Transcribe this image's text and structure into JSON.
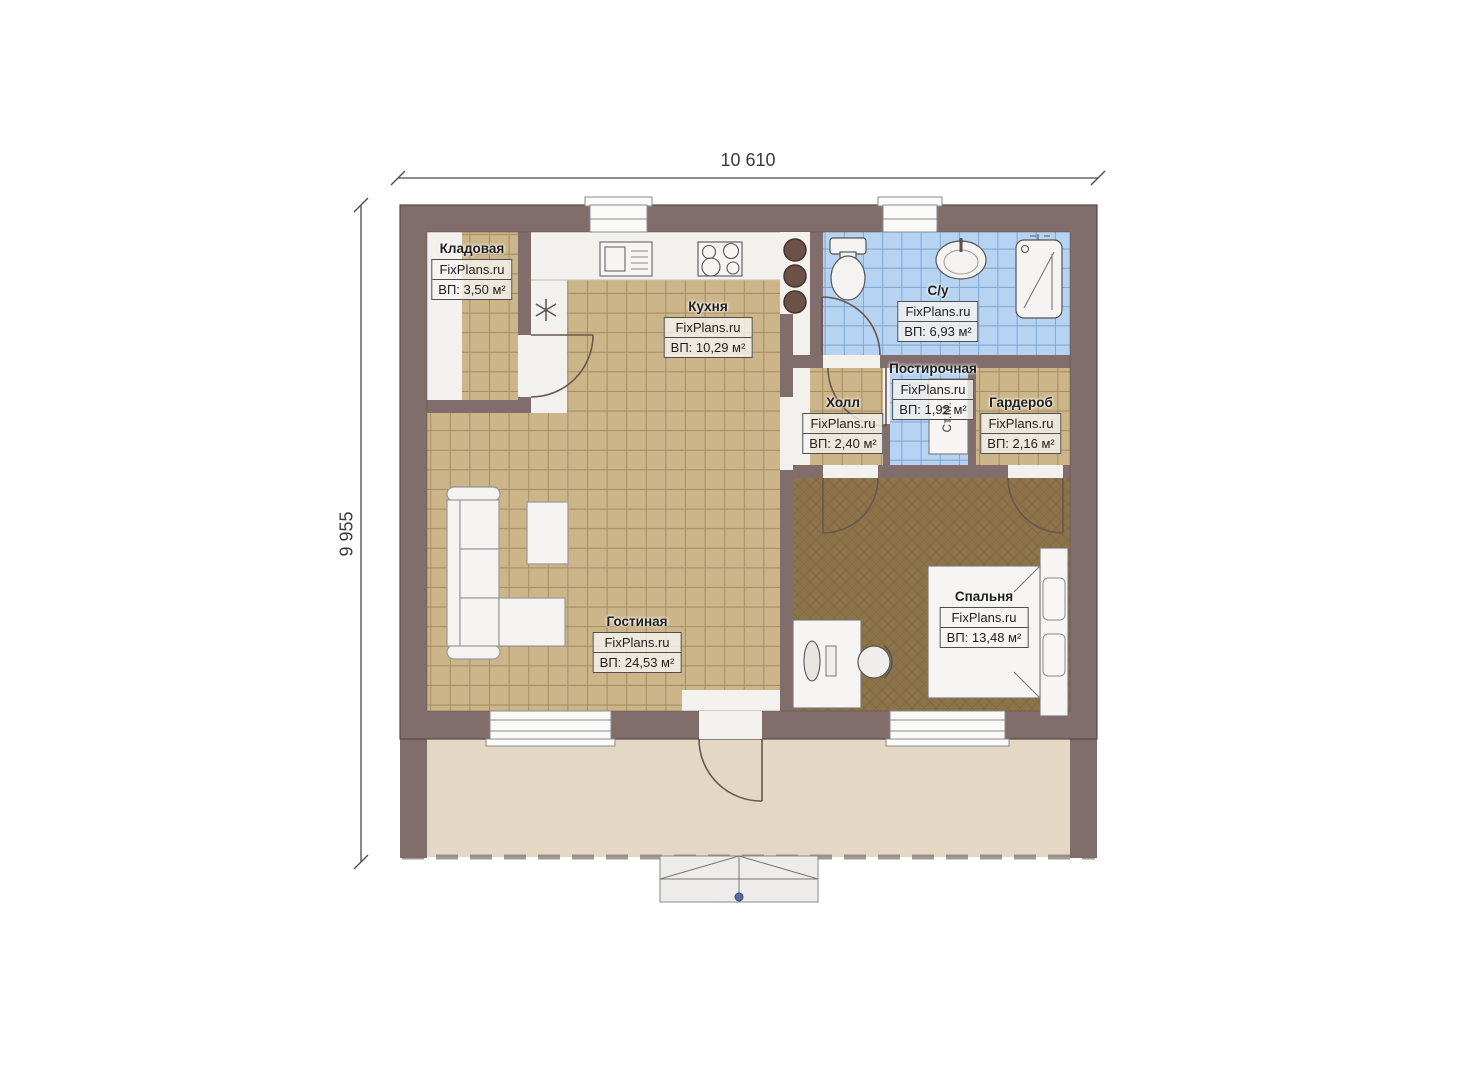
{
  "document": {
    "type": "house-floor-plan"
  },
  "dimensions": {
    "width": "10 610",
    "height": "9 955"
  },
  "watermark": "FixPlans.ru",
  "rooms": [
    {
      "id": "storage",
      "name": "Кладовая",
      "watermark": "FixPlans.ru",
      "area": "ВП: 3,50 м²"
    },
    {
      "id": "kitchen",
      "name": "Кухня",
      "watermark": "FixPlans.ru",
      "area": "ВП: 10,29 м²"
    },
    {
      "id": "bathroom",
      "name": "С/у",
      "watermark": "FixPlans.ru",
      "area": "ВП: 6,93 м²"
    },
    {
      "id": "hall",
      "name": "Холл",
      "watermark": "FixPlans.ru",
      "area": "ВП: 2,40 м²"
    },
    {
      "id": "laundry",
      "name": "Постирочная",
      "watermark": "FixPlans.ru",
      "area": "ВП: 1,92 м²"
    },
    {
      "id": "wardrobe",
      "name": "Гардероб",
      "watermark": "FixPlans.ru",
      "area": "ВП: 2,16 м²"
    },
    {
      "id": "living",
      "name": "Гостиная",
      "watermark": "FixPlans.ru",
      "area": "ВП: 24,53 м²"
    },
    {
      "id": "bedroom",
      "name": "Спальня",
      "watermark": "FixPlans.ru",
      "area": "ВП: 13,48 м²"
    }
  ],
  "annotations": {
    "washing_machine": "Ст.М."
  },
  "colors": {
    "wall": "#816d6c",
    "tile_tan": "#cdb58a",
    "tile_blue": "#b6d3f1",
    "bedroom_floor": "#8c734a",
    "terrace": "#e4d8c4",
    "interior_white": "#f2f1ee"
  }
}
